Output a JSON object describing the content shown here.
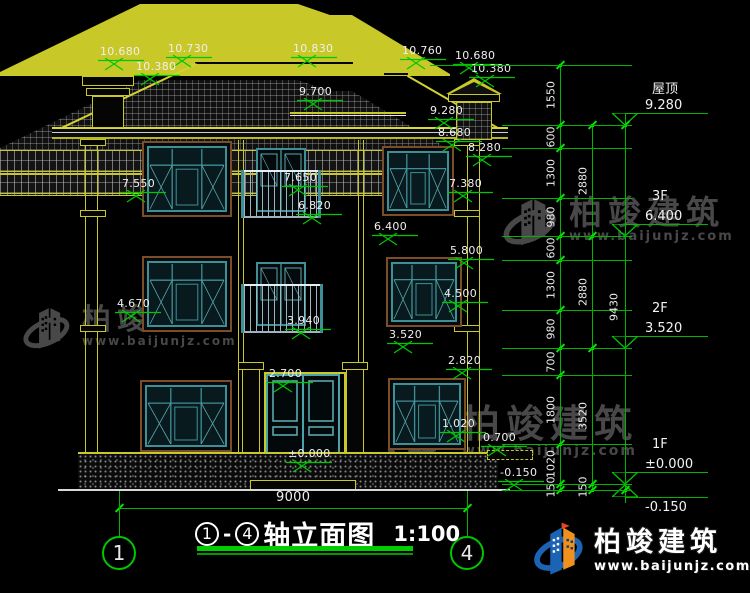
{
  "drawing_title": {
    "axis_from": "1",
    "dash": "-",
    "axis_to": "4",
    "name": "轴立面图",
    "scale": "1:100"
  },
  "axis_bubbles": {
    "left": "1",
    "right": "4"
  },
  "bottom_dim": "9000",
  "levels": [
    {
      "name": "屋顶",
      "elev": "9.280"
    },
    {
      "name": "3F",
      "elev": "6.400"
    },
    {
      "name": "2F",
      "elev": "3.520"
    },
    {
      "name": "1F",
      "elev": "±0.000"
    },
    {
      "name": "",
      "elev": "-0.150"
    }
  ],
  "dim_chains": {
    "inner": [
      "1550",
      "600",
      "1300",
      "980",
      "600",
      "1300",
      "980",
      "700",
      "1800",
      "1020",
      "150"
    ],
    "outer": [
      "2880",
      "2880",
      "3520",
      "150"
    ],
    "total": "9430"
  },
  "elevation_markers": [
    {
      "id": "chimney-left-top",
      "label": "10.680"
    },
    {
      "id": "ridge-left",
      "label": "10.730"
    },
    {
      "id": "chimney-left-eave",
      "label": "10.380"
    },
    {
      "id": "ridge-main",
      "label": "10.830"
    },
    {
      "id": "eave-center",
      "label": "9.700"
    },
    {
      "id": "ridge-right",
      "label": "10.760"
    },
    {
      "id": "chimney-right-top",
      "label": "10.680"
    },
    {
      "id": "chimney-right-eave",
      "label": "10.380"
    },
    {
      "id": "roof-right",
      "label": "9.280"
    },
    {
      "id": "eave-main",
      "label": "8.680"
    },
    {
      "id": "eave-low",
      "label": "8.280"
    },
    {
      "id": "3f-window-top-left",
      "label": "7.550"
    },
    {
      "id": "3f-door-top",
      "label": "7.650"
    },
    {
      "id": "3f-window-top-right",
      "label": "7.380"
    },
    {
      "id": "3f-balcony-rail",
      "label": "6.820"
    },
    {
      "id": "3f-floor",
      "label": "6.400"
    },
    {
      "id": "2f-window-top",
      "label": "5.800"
    },
    {
      "id": "2f-window-sill-left",
      "label": "4.670"
    },
    {
      "id": "2f-window-sill-right",
      "label": "4.500"
    },
    {
      "id": "2f-balcony-rail",
      "label": "3.940"
    },
    {
      "id": "2f-floor",
      "label": "3.520"
    },
    {
      "id": "1f-door-top",
      "label": "2.700"
    },
    {
      "id": "1f-window-top",
      "label": "2.820"
    },
    {
      "id": "1f-window-sill",
      "label": "1.020"
    },
    {
      "id": "1f-side-step",
      "label": "0.700"
    },
    {
      "id": "1f-floor",
      "label": "±0.000"
    },
    {
      "id": "ground",
      "label": "-0.150"
    }
  ],
  "watermark": {
    "brand": "柏竣建筑",
    "url": "www.baijunjz.com"
  },
  "logo": {
    "brand": "柏竣建筑",
    "url": "www.baijunjz.com"
  },
  "colors": {
    "line_green": "#00c800",
    "line_yellow": "#c8c828",
    "window_teal": "#3f8f96",
    "trim_brown": "#7a4e28",
    "text_white": "#f0f0f0",
    "logo_blue": "#1b63b5",
    "logo_orange": "#f0901e"
  }
}
